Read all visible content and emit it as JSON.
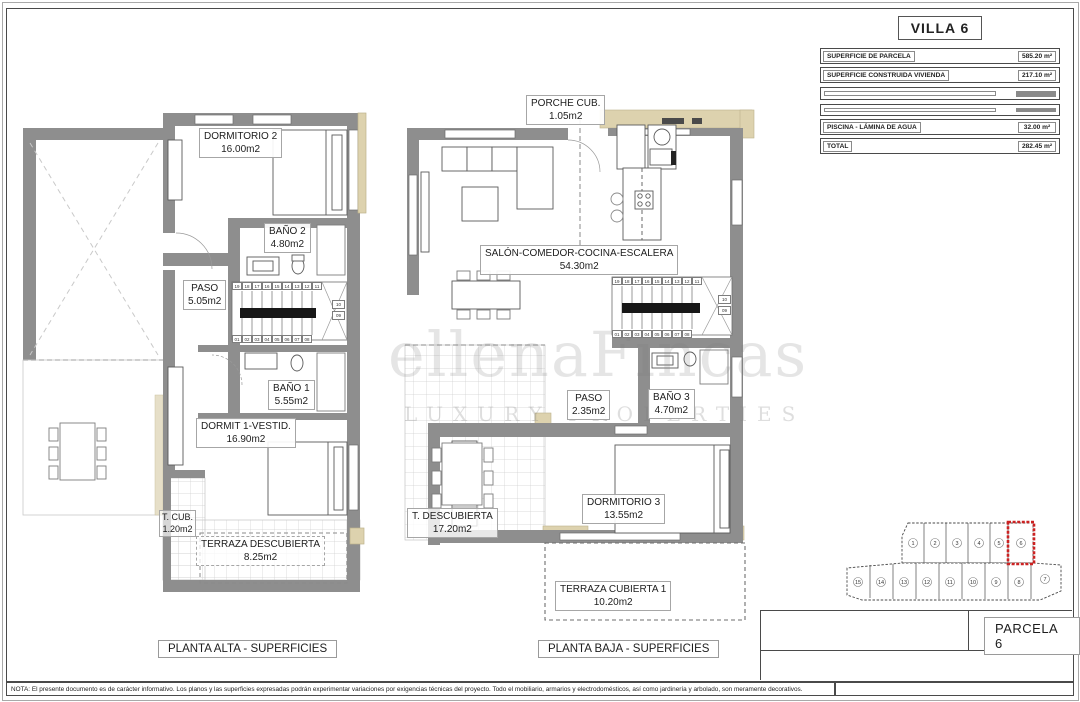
{
  "sheet": {
    "note": "NOTA: El presente documento es de carácter informativo. Los planos y las superficies expresadas podrán experimentar variaciones por exigencias técnicas del proyecto. Todo el mobiliario, armarios y electrodomésticos, así como jardinería y arbolado, son meramente decorativos.",
    "watermark_line1": "ellenaFincas",
    "watermark_line2": "LUXURY PROPERTIES"
  },
  "villa_table": {
    "title": "VILLA 6",
    "top_rows": [
      {
        "label": "SUPERFICIE DE PARCELA",
        "value": "585.20 m²"
      },
      {
        "label": "SUPERFICIE CONSTRUIDA VIVIENDA",
        "value": "217.10 m²"
      }
    ],
    "construida": [
      {
        "label": "SUPERFICIE CONSTRUIDA PLANTA BAJA",
        "value": "87.30 m²"
      },
      {
        "label": "SUPERFICIE CONSTRUIDA PLANTA PRIMERA",
        "value": "54.75 m²"
      },
      {
        "label": "SUPERFICIE TERRAZAS CUBIERTAS P. BAJA (100%)",
        "value": "11.20 m²"
      },
      {
        "label": "SUPERFICIE TERRAZA CUBIERTA P.1 (100%)",
        "value": "1.20 m²"
      },
      {
        "label": "SUPERFICIE SÓTANO",
        "value": "62.65 m²"
      }
    ],
    "descubierta": [
      {
        "label": "SUPERFICIE TERRAZA DESCUBIERTA P.B.",
        "value": "17.20 m²"
      },
      {
        "label": "SUPERFICIE TERRAZA DESCUBIERTA P.1",
        "value": "8.25 m²"
      },
      {
        "label": "SUPERFICIE TERRAZA DESCUBIERTA SÓTANO",
        "value": "7.90 m²"
      }
    ],
    "piscina": {
      "label": "PISCINA - LÁMINA DE AGUA",
      "value": "32.00 m²"
    },
    "total": {
      "label": "TOTAL",
      "value": "282.45 m²"
    }
  },
  "plans": {
    "alta": {
      "caption": "PLANTA ALTA - SUPERFICIES",
      "rooms": {
        "dormitorio2": {
          "name": "DORMITORIO 2",
          "area": "16.00m2"
        },
        "bano2": {
          "name": "BAÑO 2",
          "area": "4.80m2"
        },
        "paso": {
          "name": "PASO",
          "area": "5.05m2"
        },
        "bano1": {
          "name": "BAÑO 1",
          "area": "5.55m2"
        },
        "dormit1": {
          "name": "DORMIT 1-VESTID.",
          "area": "16.90m2"
        },
        "tcub": {
          "name": "T. CUB.",
          "area": "1.20m2"
        },
        "terraza": {
          "name": "TERRAZA DESCUBIERTA",
          "area": "8.25m2"
        }
      }
    },
    "baja": {
      "caption": "PLANTA BAJA - SUPERFICIES",
      "rooms": {
        "porche": {
          "name": "PORCHE CUB.",
          "area": "1.05m2"
        },
        "salon": {
          "name": "SALÓN-COMEDOR-COCINA-ESCALERA",
          "area": "54.30m2"
        },
        "paso": {
          "name": "PASO",
          "area": "2.35m2"
        },
        "bano3": {
          "name": "BAÑO 3",
          "area": "4.70m2"
        },
        "dormitorio3": {
          "name": "DORMITORIO 3",
          "area": "13.55m2"
        },
        "tdescubierta": {
          "name": "T. DESCUBIERTA",
          "area": "17.20m2"
        },
        "terrazacubierta": {
          "name": "TERRAZA CUBIERTA 1",
          "area": "10.20m2"
        }
      }
    }
  },
  "stairs": {
    "top": [
      "19",
      "18",
      "17",
      "16",
      "15",
      "14",
      "13",
      "12",
      "11"
    ],
    "bottom": [
      "01",
      "02",
      "03",
      "04",
      "05",
      "06",
      "07",
      "08"
    ],
    "side": [
      "10",
      "09"
    ]
  },
  "parcel_map": {
    "top_row": [
      "1",
      "2",
      "3",
      "4",
      "5",
      "6"
    ],
    "bottom_row": [
      "15",
      "14",
      "13",
      "12",
      "11",
      "10",
      "9",
      "8",
      "7"
    ],
    "highlighted_parcel": "6"
  },
  "title_block": {
    "parcela_label": "PARCELA 6"
  },
  "colors": {
    "wall": "#8e8e8e",
    "beige": "#ddd2ae",
    "highlight_red": "#cc2222"
  }
}
